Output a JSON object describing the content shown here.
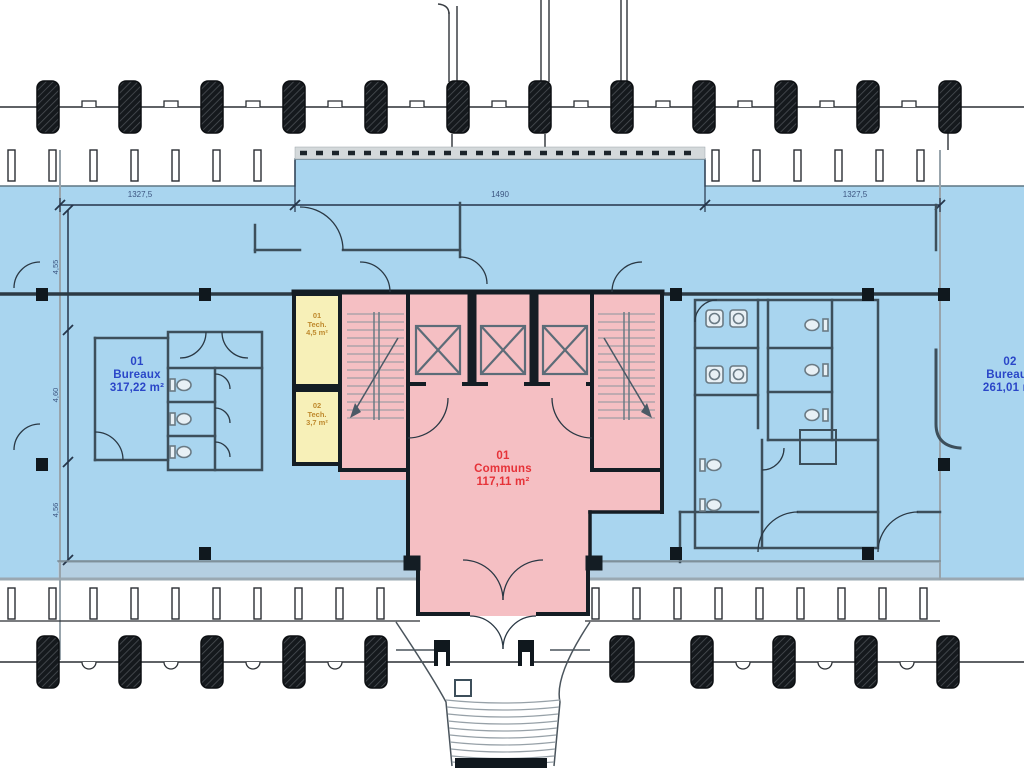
{
  "rooms": {
    "bureaux_left": {
      "id": "01",
      "name": "Bureaux",
      "area": "317,22 m²"
    },
    "bureaux_right": {
      "id": "02",
      "name": "Bureaux",
      "area": "261,01 m²"
    },
    "communs": {
      "id": "01",
      "name": "Communs",
      "area": "117,11 m²"
    },
    "tech_1": {
      "id": "01",
      "name": "Tech.",
      "area": "4,5 m²"
    },
    "tech_2": {
      "id": "02",
      "name": "Tech.",
      "area": "3,7 m²"
    }
  },
  "dimensions": {
    "top_left": "1327,5",
    "top_center": "1490",
    "top_right": "1327,5",
    "left_upper": "4,55",
    "left_middle": "4,60",
    "left_lower": "4,56"
  },
  "colors": {
    "office_fill": "#a9d5ef",
    "commons_fill": "#f5bfc3",
    "tech_fill": "#f7f0b8",
    "office_text": "#2a46c8",
    "commons_text": "#e63238",
    "tech_text": "#bf8a2e",
    "dim_text": "#3c5580",
    "wall": "#141d24"
  }
}
